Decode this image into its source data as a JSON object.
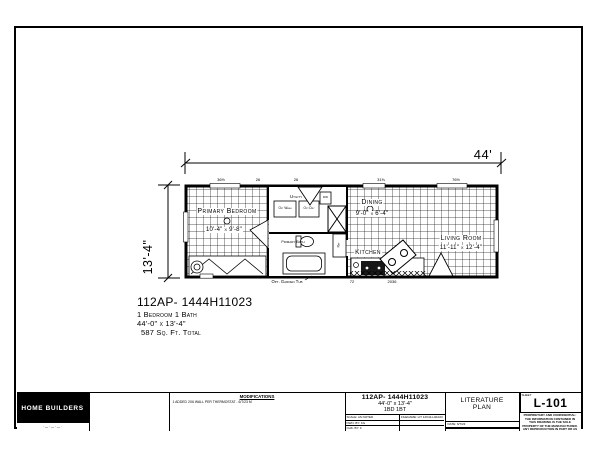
{
  "sheet": {
    "bg": "#ffffff",
    "frame_color": "#000000"
  },
  "plan": {
    "dim_width": "44'",
    "dim_height": "13'-4\"",
    "rooms": {
      "primary_bedroom": {
        "name": "Primary Bedroom",
        "dims": "10'-4\" x 9'-8\""
      },
      "dining": {
        "name": "Dining",
        "dims": "9'-0\" x 6'-4\""
      },
      "living_room": {
        "name": "Living Room",
        "dims": "11'-11\" x 12'-4\""
      },
      "kitchen": {
        "name": "Kitchen"
      },
      "utility": {
        "name": "Utility"
      },
      "primary_bath": {
        "name": "Primary Bath"
      }
    },
    "fixtures": {
      "washer": "Opt Wash",
      "dryer": "Opt Dry",
      "ref": "Ref",
      "dw": "DW",
      "garden_tub": "Opt. Garden Tub"
    },
    "ticks_top": [
      "36½",
      "26",
      "26",
      "31⅜",
      "76½"
    ],
    "ticks_bottom": [
      "72",
      "2036"
    ]
  },
  "summary": {
    "model": "112AP- 1444H11023",
    "beds": "1 Bedroom 1 Bath",
    "size": "44'-0\" x 13'-4\"",
    "area": "587 Sq. Ft. Total"
  },
  "titleblock": {
    "logo": {
      "name": "HOME BUILDERS",
      "tagline": "· — · — · — ·"
    },
    "modifications": {
      "header": "MODIFICATIONS",
      "note": "1   ADDED 2X6 WALL PER THERMOSTAT  -  6/7/23   M"
    },
    "plan_info": {
      "model": "112AP- 1444H11023",
      "size": "44'-0\" x 13'-4\"",
      "bedbath": "1BD 1BT",
      "field1": "SCALE: AS NOTED",
      "field2": "DWN. BY: KG",
      "field3": "CHK. BY: F",
      "filename": "FILENAME: LIT 14X44-H11023"
    },
    "sheet_title": {
      "line1": "LITERATURE",
      "line2": "PLAN",
      "date": "DATE: 6/7/23"
    },
    "sheet_no": {
      "label": "SHEET",
      "number": "L-101",
      "fineprint": "PROPRIETARY AND CONFIDENTIAL: THE INFORMATION CONTAINED IN THIS DRAWING IS THE SOLE PROPERTY OF THE MANUFACTURER. ANY REPRODUCTION IN PART OR AS A WHOLE WITHOUT WRITTEN PERMISSION IS PROHIBITED."
    }
  }
}
